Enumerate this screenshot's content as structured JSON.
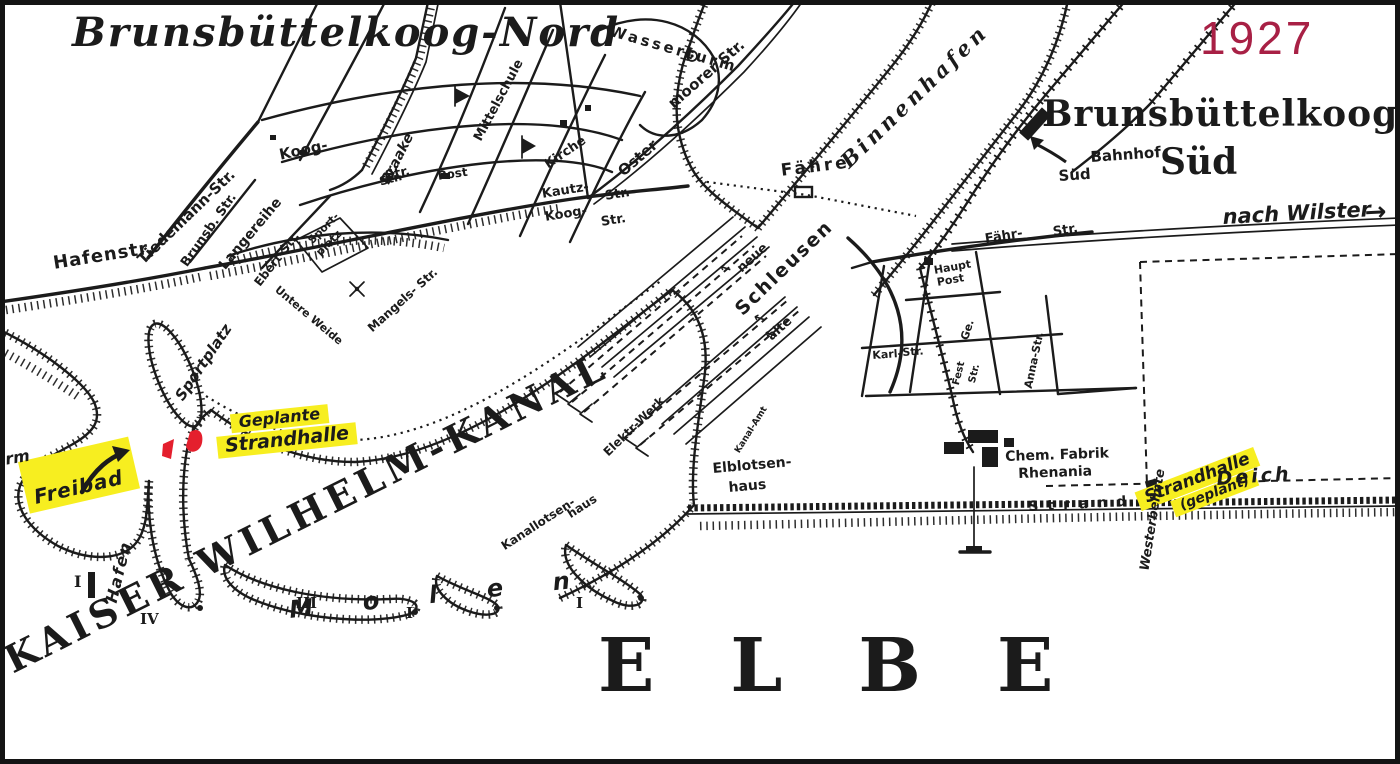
{
  "meta": {
    "year": "1927"
  },
  "colors": {
    "paper": "#ffffff",
    "ink": "#1b1b1b",
    "highlight_yellow": "#f7ee20",
    "mark_red": "#e41f2d",
    "year_red": "#a82045"
  },
  "titles": {
    "nord": "Brunsbüttelkoog-Nord",
    "sued_line1": "Brunsbüttelkoog-",
    "sued_line2": "Süd",
    "canal": "KAISER WILHELM-KANAL",
    "river": "ELBE",
    "molen": "Molen",
    "binnenhafen": "Binnenhafen"
  },
  "highlights": {
    "freibad": "Freibad",
    "geplante_line1": "Geplante",
    "geplante_line2": "Strandhalle",
    "strandhalle_line1": "Strandhalle",
    "strandhalle_line2": "(geplant)"
  },
  "labels": {
    "nach_wilster": "nach Wilster",
    "arrow_right": "→",
    "arrow_left": "←",
    "bahnhof_line1": "Bahnhof",
    "bahnhof_line2": "Süd",
    "wasserturm": "Wasserturm",
    "moorer_str": "moorer Str.",
    "oster": "Oster",
    "kirche": "Kirche",
    "post": "Post",
    "haupt_post_line1": "Haupt",
    "haupt_post_line2": "Post",
    "kautz": "Kautz-",
    "kautz_str": "Str.",
    "koog2": "Koog-",
    "koog2_str": "Str.",
    "mittelschule": "Mittelschule",
    "braake": "Braake",
    "braake_str": "Str.",
    "hafenstr": "Hafenstr.",
    "tiedemann": "Tiedemann-Str.",
    "brunsb": "Brunsb. Str.",
    "langereihe": "Langereihe",
    "ebert": "Ebert-Str.",
    "koog": "Koog-",
    "koog_str": "Str.",
    "sport_line1": "Sport-",
    "sport_line2": "platz",
    "sportplatz": "Sportplatz",
    "mangels": "Mangels- Str.",
    "untere_weide": "Untere Weide",
    "faehre": "Fähre",
    "neue": "neue",
    "schleusen": "Schleusen",
    "alte": "alte",
    "elektr_werk": "Elektr-Werk",
    "kanal_amt": "Kanal-Amt",
    "elblotsen_line1": "Elblotsen-",
    "elblotsen_line2": "haus",
    "kanallotsen_line1": "Kanallotsen-",
    "kanallotsen_line2": "haus",
    "faehr": "Fähr-",
    "faehr_str": "Str.",
    "ge": "Ge.",
    "fest": "Fest",
    "fest_str": "Str.",
    "anna_str": "Anna-Str.",
    "karl": "Karl-",
    "karl_str": "Str.",
    "westerbelmte": "Westerbelmte",
    "chem_line1": "Chem. Fabrik",
    "chem_line2": "Rhenania",
    "strand": "Strand",
    "deich": "Deich",
    "hafen": "Hafen",
    "rm_fragment": "rm",
    "numeral_I_a": "I",
    "numeral_IV": "IV",
    "numeral_III": "III",
    "numeral_I_b": "I",
    "numeral_I_c": "I"
  }
}
